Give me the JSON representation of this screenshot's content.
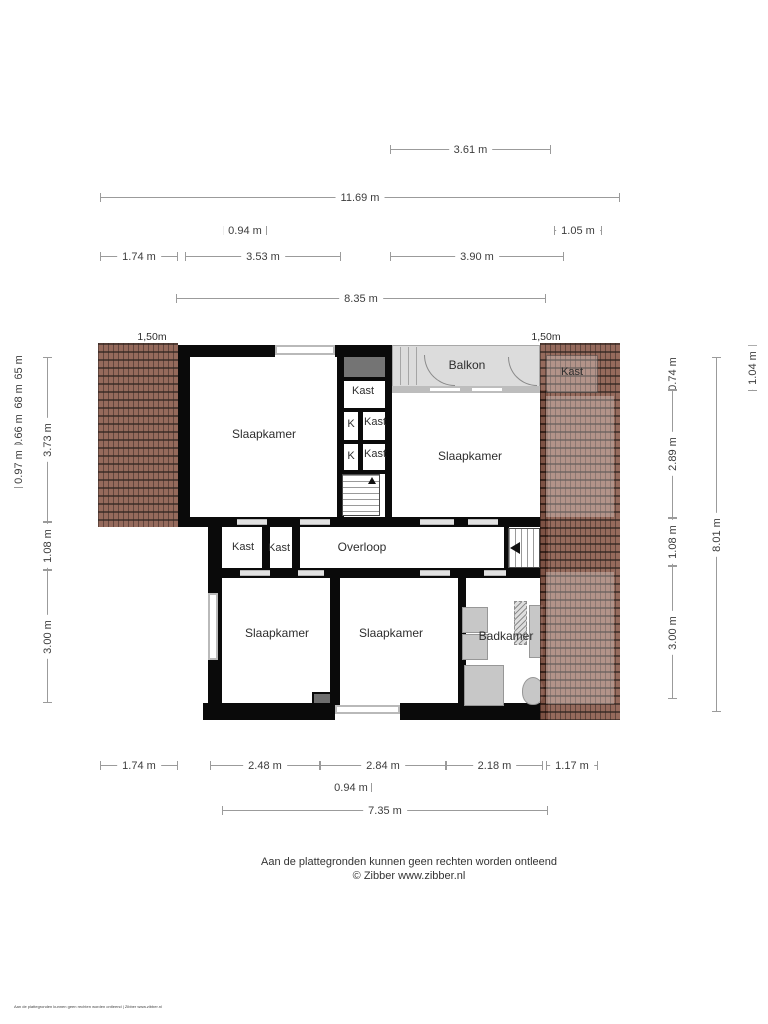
{
  "dims": {
    "top": [
      "3.61 m",
      "11.69 m",
      "0.94 m",
      "1.05 m",
      "1.74 m",
      "3.53 m",
      "3.90 m",
      "8.35 m"
    ],
    "left": [
      "0.65 m",
      "0.68 m",
      "0.66 m",
      "0.97 m",
      "3.73 m",
      "1.08 m",
      "3.00 m"
    ],
    "right": [
      "0.74 m",
      "2.89 m",
      "1.08 m",
      "3.00 m",
      "8.01 m",
      "1.04 m"
    ],
    "bottom": [
      "1.74 m",
      "2.48 m",
      "2.84 m",
      "2.18 m",
      "1.17 m",
      "0.94 m",
      "7.35 m"
    ]
  },
  "scale_labels": {
    "left": "1,50m",
    "right": "1,50m"
  },
  "rooms": {
    "slaapkamer_top_left": "Slaapkamer",
    "slaapkamer_top_right": "Slaapkamer",
    "slaapkamer_bottom_left": "Slaapkamer",
    "slaapkamer_bottom_mid": "Slaapkamer",
    "badkamer": "Badkamer",
    "overloop": "Overloop",
    "balkon": "Balkon",
    "kast_top": "Kast",
    "kast_mid_1": "Kast",
    "kast_mid_2": "Kast",
    "k_1": "K",
    "k_2": "K",
    "kast_hall_1": "Kast",
    "kast_hall_2": "Kast",
    "kast_roof": "Kast"
  },
  "footer": {
    "disclaimer": "Aan de plattegronden kunnen geen rechten worden ontleend",
    "copyright": "© Zibber www.zibber.nl",
    "fineprint": "Aan de plattegronden kunnen geen rechten worden ontleend | Zibber www.zibber.nl"
  },
  "colors": {
    "wall": "#0a0a0a",
    "roof": "#8a5a4b",
    "roof_grid": "#3f2d27",
    "balkon": "#dcdcdc",
    "fixture": "#c7c7c7",
    "dim_line": "#9b9b9b",
    "dim_text": "#3d3d3d"
  }
}
